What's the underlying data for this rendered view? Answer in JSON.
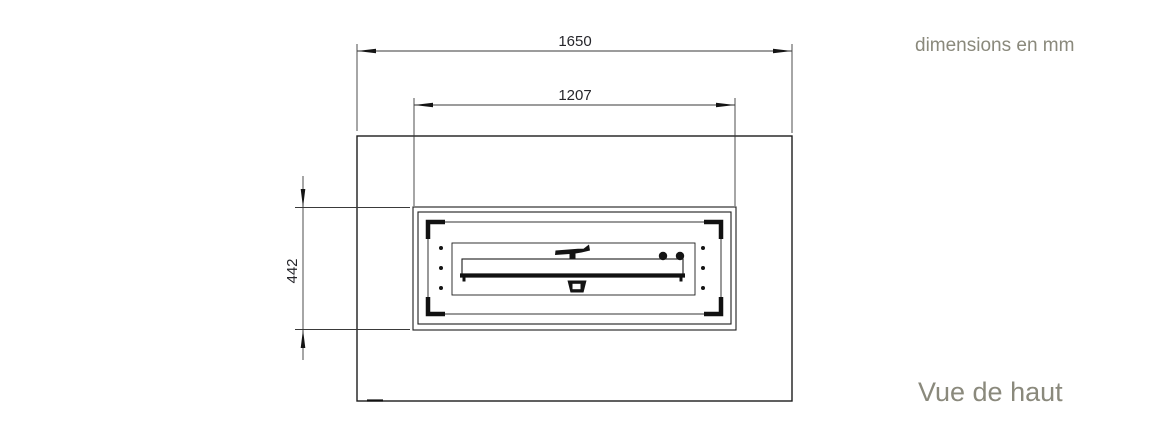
{
  "annotations": {
    "units_note": "dimensions en mm",
    "view_label": "Vue de haut",
    "text_color": "#8a897c"
  },
  "dimensions": {
    "overall_width_mm": "1650",
    "burner_frame_width_mm": "1207",
    "burner_frame_depth_mm": "442"
  },
  "colors": {
    "drawing_line": "#1d1d1d",
    "dimension_text": "#26262b",
    "background": "#ffffff"
  }
}
